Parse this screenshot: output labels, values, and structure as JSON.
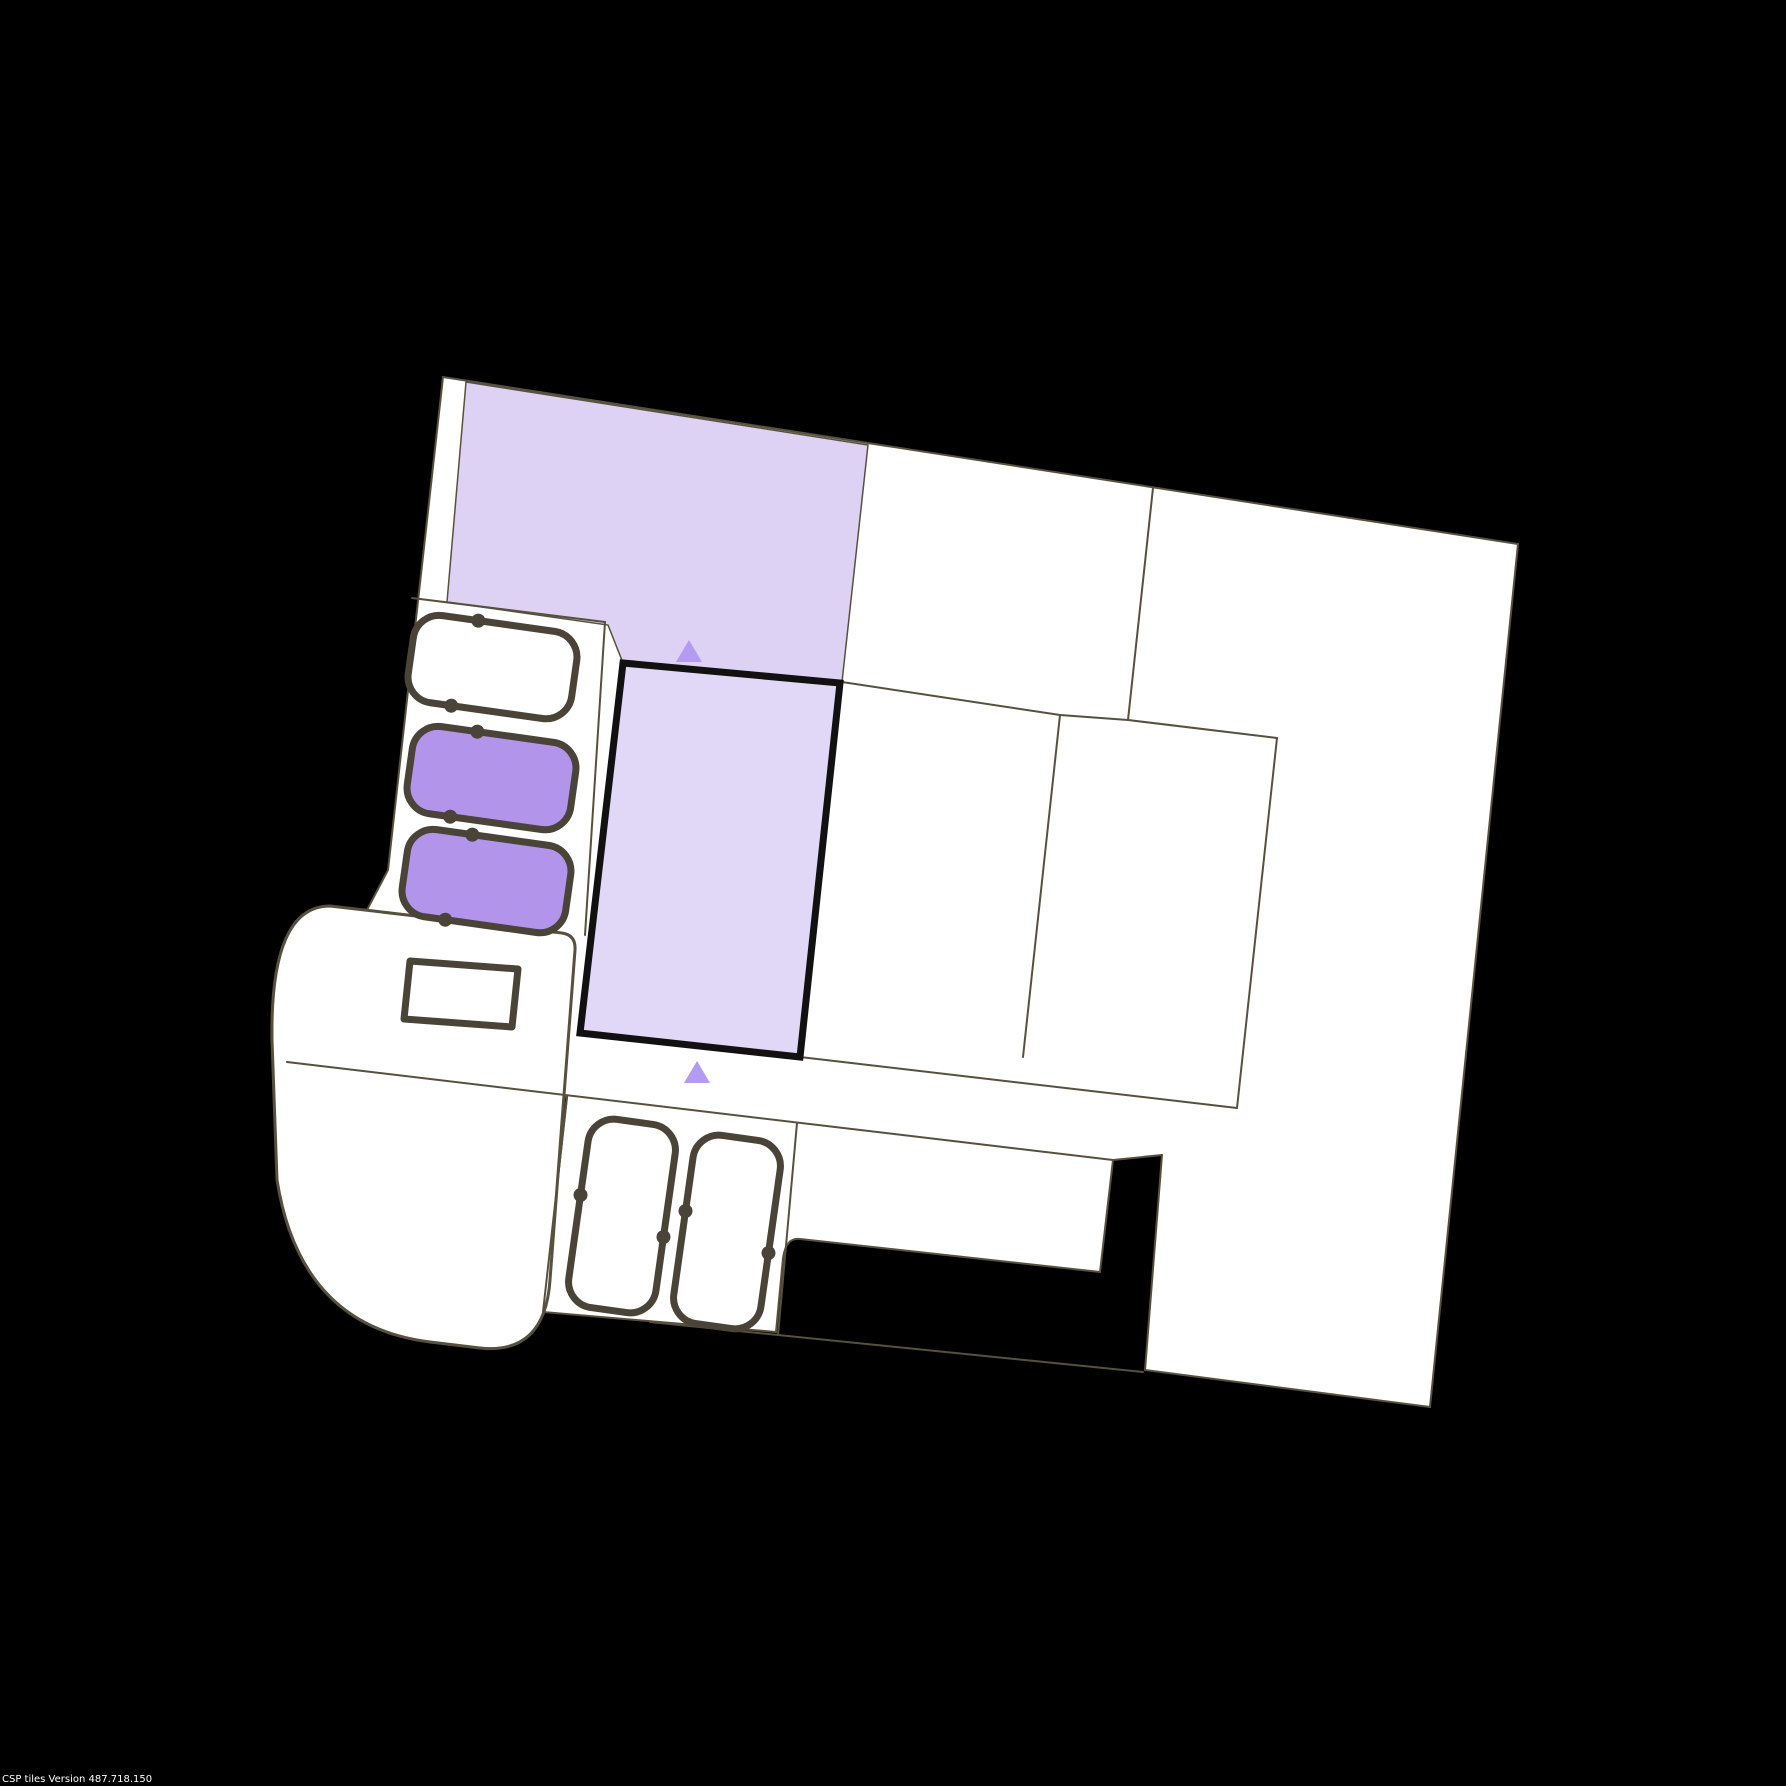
{
  "watermark": {
    "text": "CSP tiles Version 487.718.150"
  },
  "colors": {
    "background": "#000000",
    "floor": "#ffffff",
    "wall": "#57503e",
    "furniture_stroke": "#4a4438",
    "zone_light": "#ddd2f3",
    "zone_room": "#e1d7f6",
    "vehicle_purple": "#b294ea",
    "marker": "#b49af0",
    "selection_border": "#111111"
  },
  "map": {
    "type": "indoor-floor-plan",
    "rotation_deg": 8,
    "zones": [
      {
        "id": "upper-highlight-zone",
        "fill": "light-purple"
      },
      {
        "id": "selected-room",
        "fill": "light-purple",
        "border": "thick-black"
      }
    ],
    "markers": [
      {
        "id": "entrance-marker-top",
        "shape": "triangle-up"
      },
      {
        "id": "entrance-marker-bottom",
        "shape": "triangle-up"
      }
    ],
    "parking": {
      "horizontal_spots": [
        {
          "id": "spot-1",
          "fill": "white"
        },
        {
          "id": "spot-2",
          "fill": "purple"
        },
        {
          "id": "spot-3",
          "fill": "purple"
        }
      ],
      "vertical_spots": [
        {
          "id": "spot-4",
          "fill": "white"
        },
        {
          "id": "spot-5",
          "fill": "white"
        }
      ],
      "kiosk_count": 1
    }
  }
}
